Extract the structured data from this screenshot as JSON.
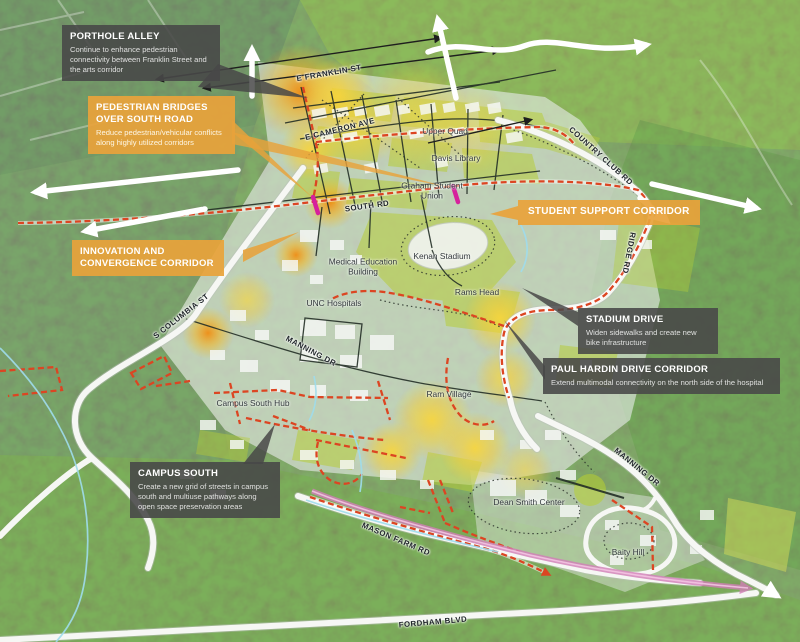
{
  "callouts": [
    {
      "id": "porthole-alley",
      "style": "dark",
      "title": "PORTHOLE ALLEY",
      "body": "Continue to enhance pedestrian connectivity between Franklin Street and the arts corridor"
    },
    {
      "id": "pedestrian-bridges",
      "style": "orange",
      "title": "PEDESTRIAN BRIDGES OVER SOUTH ROAD",
      "body": "Reduce pedestrian/vehicular conflicts along highly utilized corridors"
    },
    {
      "id": "innovation-convergence",
      "style": "orange",
      "title": "INNOVATION AND CONVERGENCE CORRIDOR",
      "body": ""
    },
    {
      "id": "student-support",
      "style": "orange",
      "title": "STUDENT SUPPORT CORRIDOR",
      "body": ""
    },
    {
      "id": "stadium-drive",
      "style": "dark",
      "title": "STADIUM DRIVE",
      "body": "Widen sidewalks and create new bike infrastructure"
    },
    {
      "id": "paul-hardin",
      "style": "dark",
      "title": "PAUL HARDIN DRIVE CORRIDOR",
      "body": "Extend multimodal connectivity on the north side of the hospital"
    },
    {
      "id": "campus-south",
      "style": "dark",
      "title": "CAMPUS SOUTH",
      "body": "Create a new grid of streets in campus south and multiuse pathways along open space preservation areas"
    }
  ],
  "road_labels": [
    {
      "id": "e-franklin-st",
      "text": "E FRANKLIN ST"
    },
    {
      "id": "e-cameron-ave",
      "text": "E CAMERON AVE"
    },
    {
      "id": "country-club-rd",
      "text": "COUNTRY CLUB RD"
    },
    {
      "id": "south-rd",
      "text": "SOUTH RD"
    },
    {
      "id": "ridge-rd",
      "text": "RIDGE RD"
    },
    {
      "id": "s-columbia-st",
      "text": "S COLUMBIA ST"
    },
    {
      "id": "manning-dr-west",
      "text": "MANNING DR"
    },
    {
      "id": "manning-dr-east",
      "text": "MANNING DR"
    },
    {
      "id": "mason-farm-rd",
      "text": "MASON FARM RD"
    },
    {
      "id": "fordham-blvd",
      "text": "FORDHAM BLVD"
    }
  ],
  "place_labels": [
    {
      "id": "upper-quad",
      "text": "Upper Quad"
    },
    {
      "id": "davis-library",
      "text": "Davis Library"
    },
    {
      "id": "graham-student-union",
      "text": "Graham Student Union"
    },
    {
      "id": "kenan-stadium",
      "text": "Kenan Stadium"
    },
    {
      "id": "medical-education-building",
      "text": "Medical Education Building"
    },
    {
      "id": "unc-hospitals",
      "text": "UNC Hospitals"
    },
    {
      "id": "rams-head",
      "text": "Rams Head"
    },
    {
      "id": "ram-village",
      "text": "Ram Village"
    },
    {
      "id": "campus-south-hub",
      "text": "Campus South Hub"
    },
    {
      "id": "dean-smith-center",
      "text": "Dean Smith Center"
    },
    {
      "id": "baity-hill",
      "text": "Baity Hill"
    }
  ],
  "colors": {
    "accent_orange": "#E8A23B",
    "box_gray": "#4A4A4A",
    "corridor_red": "#DC4522",
    "transit_pink": "#D27FB8",
    "bridge_magenta": "#D6219C",
    "heat_yellow": "#F6CF35",
    "heat_orange": "#EF8D14",
    "overlay_green": "#B6CC3A"
  }
}
